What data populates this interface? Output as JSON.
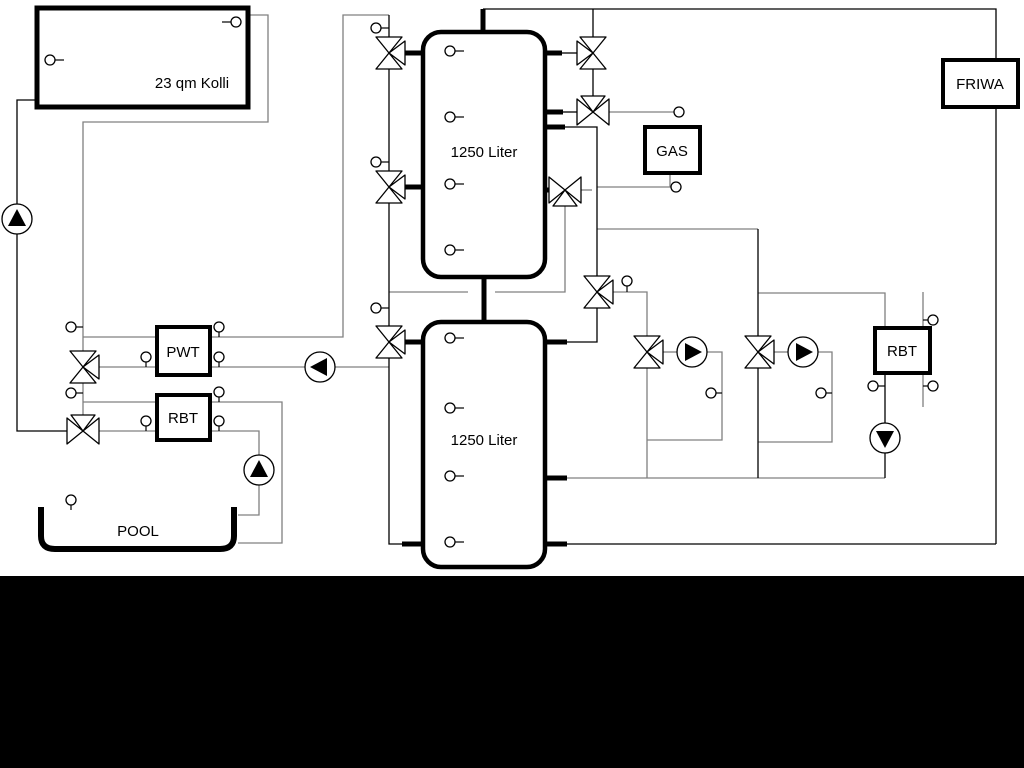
{
  "diagram": {
    "labels": {
      "collector": "23 qm Kolli",
      "tank_upper": "1250 Liter",
      "tank_lower": "1250 Liter",
      "gas": "GAS",
      "friwa": "FRIWA",
      "pwt": "PWT",
      "rbt_left": "RBT",
      "rbt_right": "RBT",
      "pool": "POOL"
    },
    "colors": {
      "primary_line": "#000000",
      "secondary_line": "#808080",
      "background": "#ffffff",
      "bottom_band": "#000000"
    }
  }
}
